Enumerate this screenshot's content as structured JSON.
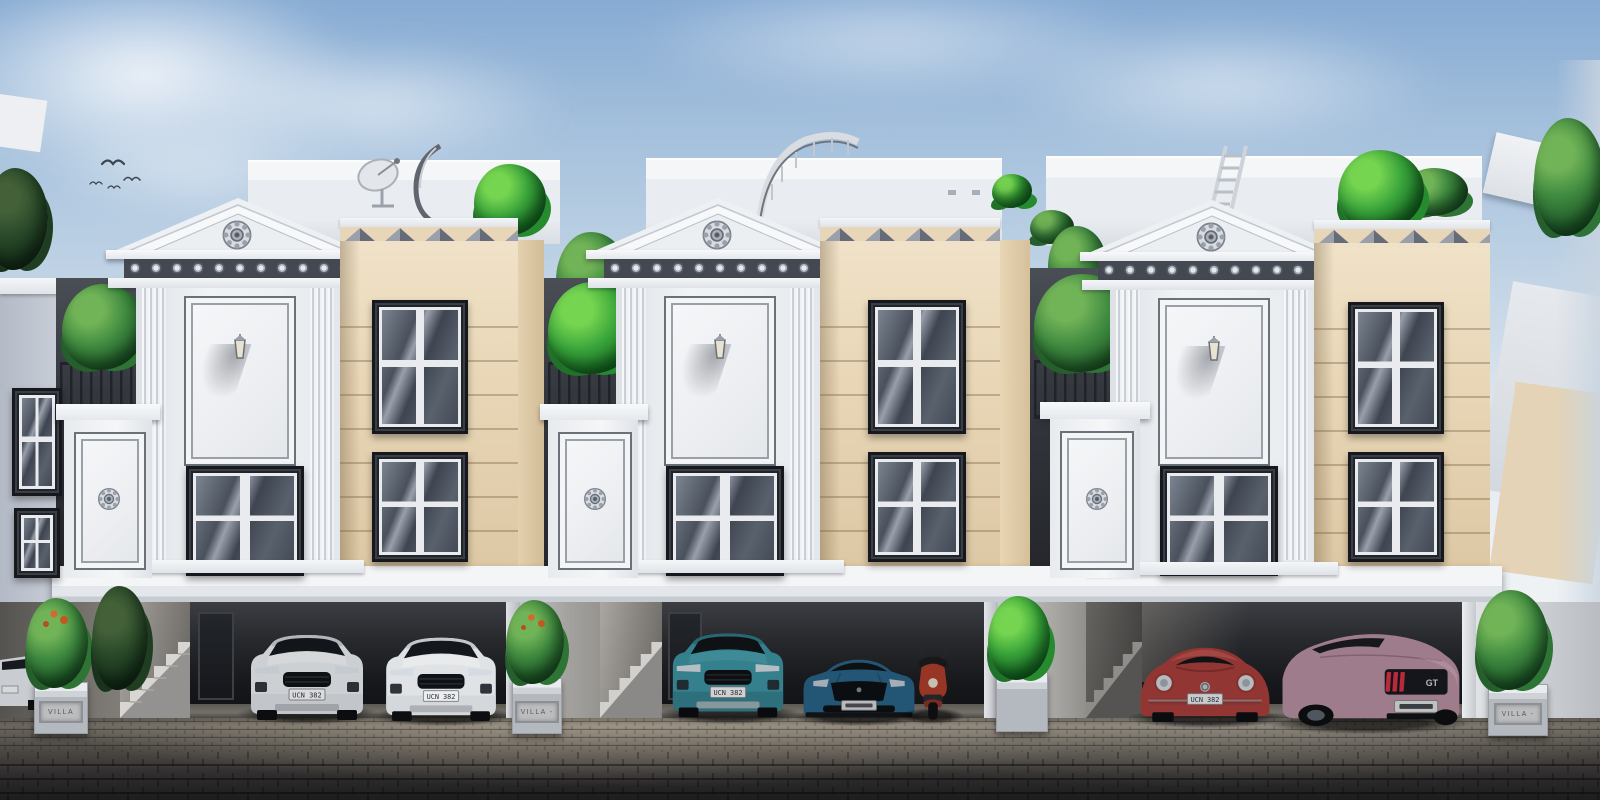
{
  "scene": {
    "type": "architectural-exterior-render",
    "description": "Front elevation of a row of three neoclassical townhouse villas with rooftop terraces, pediments, balconies with plants, and ground-floor parking bays; cobblestone street in foreground; birds in blue sky",
    "time_of_day": "day",
    "palette": {
      "sky_top": "#87abd3",
      "sky_horizon": "#eef2f5",
      "white_trim": "#f2f4f6",
      "white_shadow": "#c6ccd4",
      "beige_wall": "#e9d8ba",
      "beige_shadow": "#d9c6a6",
      "window_frame": "#23262b",
      "carport_interior": "#1a1b1e",
      "pavement_light": "#827c72",
      "pavement_dark": "#1d1c1e",
      "foliage": "#2f7a38",
      "railing_iron": "#23252a",
      "car_teal": "#3d98a6",
      "car_blue": "#2c6c92",
      "car_red": "#b2423e",
      "car_pink": "#b18a9b"
    }
  },
  "villas": [
    {
      "id": "villa-1",
      "plaque": "VILLA",
      "cars": [
        {
          "type": "compact-suv",
          "color": "white",
          "plate": "UCN 382"
        },
        {
          "type": "compact-suv",
          "color": "white",
          "plate": "UCN 382"
        }
      ]
    },
    {
      "id": "villa-2",
      "plaque": "VILLA -",
      "cars": [
        {
          "type": "compact-suv",
          "color": "teal",
          "plate": "UCN 382"
        },
        {
          "type": "muscle-coupe",
          "color": "blue"
        },
        {
          "type": "scooter",
          "color": "red"
        }
      ]
    },
    {
      "id": "villa-3",
      "plaque": "VILLA -",
      "cars": [
        {
          "type": "beetle",
          "color": "red",
          "plate": "UCN 382"
        },
        {
          "type": "muscle-coupe-rear",
          "color": "pink",
          "badge": "GT"
        }
      ]
    }
  ]
}
